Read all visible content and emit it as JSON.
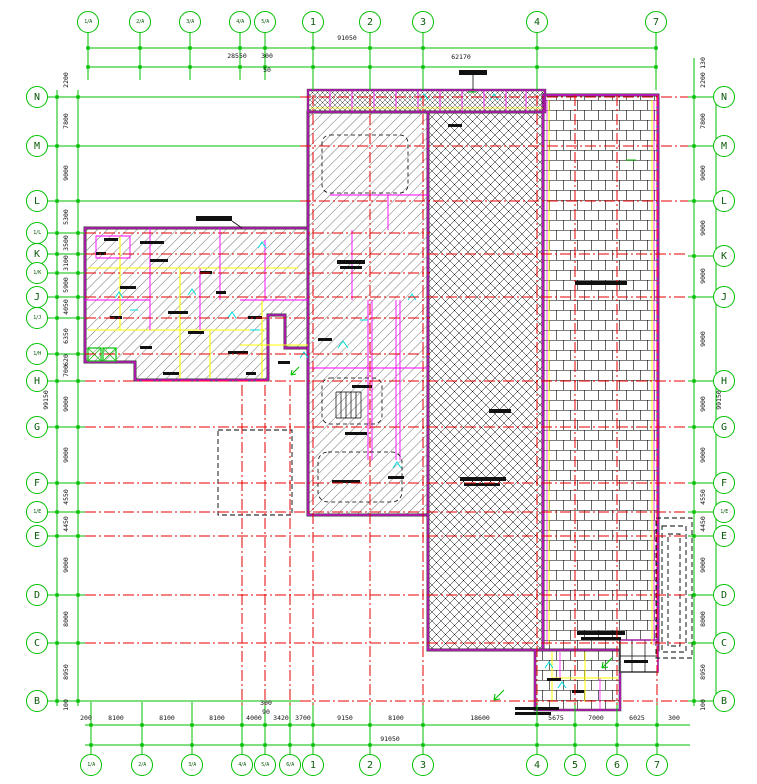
{
  "drawing": {
    "type": "architectural-floor-plan",
    "colors": {
      "grid_green": "#00c000",
      "axis_red": "#e60000",
      "wall_magenta": "#ff00ff",
      "wall_dark": "#3c3c3c",
      "accent_yellow": "#ffff00",
      "accent_cyan": "#00dcdc",
      "hatch_black": "#000000",
      "background": "#ffffff"
    },
    "axes": {
      "top": [
        {
          "label": "1/A",
          "x": 88
        },
        {
          "label": "2/A",
          "x": 140
        },
        {
          "label": "3/A",
          "x": 190
        },
        {
          "label": "4/A",
          "x": 240
        },
        {
          "label": "5/A",
          "x": 265
        },
        {
          "label": "1",
          "x": 313
        },
        {
          "label": "2",
          "x": 370
        },
        {
          "label": "3",
          "x": 423
        },
        {
          "label": "4",
          "x": 537
        },
        {
          "label": "7",
          "x": 656
        }
      ],
      "bottom": [
        {
          "label": "1/A",
          "x": 91
        },
        {
          "label": "2/A",
          "x": 142
        },
        {
          "label": "3/A",
          "x": 192
        },
        {
          "label": "4/A",
          "x": 242
        },
        {
          "label": "5/A",
          "x": 265
        },
        {
          "label": "6/A",
          "x": 290
        },
        {
          "label": "1",
          "x": 313
        },
        {
          "label": "2",
          "x": 370
        },
        {
          "label": "3",
          "x": 423
        },
        {
          "label": "4",
          "x": 537
        },
        {
          "label": "5",
          "x": 575
        },
        {
          "label": "6",
          "x": 617
        },
        {
          "label": "7",
          "x": 657
        }
      ],
      "left": [
        {
          "label": "N",
          "y": 97
        },
        {
          "label": "M",
          "y": 146
        },
        {
          "label": "L",
          "y": 201
        },
        {
          "label": "1/L",
          "y": 233
        },
        {
          "label": "K",
          "y": 254
        },
        {
          "label": "1/K",
          "y": 273
        },
        {
          "label": "J",
          "y": 297
        },
        {
          "label": "1/J",
          "y": 318
        },
        {
          "label": "1/H",
          "y": 354
        },
        {
          "label": "H",
          "y": 381
        },
        {
          "label": "G",
          "y": 427
        },
        {
          "label": "F",
          "y": 483
        },
        {
          "label": "1/E",
          "y": 512
        },
        {
          "label": "E",
          "y": 536
        },
        {
          "label": "D",
          "y": 595
        },
        {
          "label": "C",
          "y": 643
        },
        {
          "label": "B",
          "y": 701
        }
      ],
      "right": [
        {
          "label": "N",
          "y": 97
        },
        {
          "label": "M",
          "y": 146
        },
        {
          "label": "L",
          "y": 201
        },
        {
          "label": "K",
          "y": 256
        },
        {
          "label": "J",
          "y": 297
        },
        {
          "label": "H",
          "y": 381
        },
        {
          "label": "G",
          "y": 427
        },
        {
          "label": "F",
          "y": 483
        },
        {
          "label": "1/E",
          "y": 512
        },
        {
          "label": "E",
          "y": 536
        },
        {
          "label": "D",
          "y": 595
        },
        {
          "label": "C",
          "y": 643
        },
        {
          "label": "B",
          "y": 701
        }
      ]
    },
    "dims": {
      "top": [
        {
          "t": "28550",
          "x": 237,
          "y": 56
        },
        {
          "t": "300",
          "x": 267,
          "y": 56
        },
        {
          "t": "50",
          "x": 267,
          "y": 70
        },
        {
          "t": "91050",
          "x": 347,
          "y": 38
        },
        {
          "t": "62170",
          "x": 461,
          "y": 57
        }
      ],
      "bottom": [
        {
          "t": "200",
          "x": 86,
          "y": 718
        },
        {
          "t": "8100",
          "x": 116,
          "y": 718
        },
        {
          "t": "8100",
          "x": 167,
          "y": 718
        },
        {
          "t": "8100",
          "x": 217,
          "y": 718
        },
        {
          "t": "4000",
          "x": 254,
          "y": 718
        },
        {
          "t": "3420",
          "x": 281,
          "y": 718
        },
        {
          "t": "3700",
          "x": 303,
          "y": 718
        },
        {
          "t": "9150",
          "x": 345,
          "y": 718
        },
        {
          "t": "8100",
          "x": 396,
          "y": 718
        },
        {
          "t": "18600",
          "x": 480,
          "y": 718
        },
        {
          "t": "5675",
          "x": 556,
          "y": 718
        },
        {
          "t": "7000",
          "x": 596,
          "y": 718
        },
        {
          "t": "6025",
          "x": 637,
          "y": 718
        },
        {
          "t": "300",
          "x": 674,
          "y": 718
        },
        {
          "t": "91050",
          "x": 390,
          "y": 739
        },
        {
          "t": "300",
          "x": 266,
          "y": 703
        },
        {
          "t": "90",
          "x": 266,
          "y": 712
        }
      ],
      "left": [
        {
          "t": "2200",
          "x": 66,
          "y": 80,
          "rot": true
        },
        {
          "t": "7800",
          "x": 66,
          "y": 121,
          "rot": true
        },
        {
          "t": "9000",
          "x": 66,
          "y": 173,
          "rot": true
        },
        {
          "t": "5300",
          "x": 66,
          "y": 217,
          "rot": true
        },
        {
          "t": "3500",
          "x": 66,
          "y": 243,
          "rot": true
        },
        {
          "t": "3100",
          "x": 66,
          "y": 263,
          "rot": true
        },
        {
          "t": "5900",
          "x": 66,
          "y": 285,
          "rot": true
        },
        {
          "t": "4050",
          "x": 66,
          "y": 307,
          "rot": true
        },
        {
          "t": "6350",
          "x": 66,
          "y": 336,
          "rot": true
        },
        {
          "t": "620",
          "x": 66,
          "y": 360,
          "rot": true
        },
        {
          "t": "700",
          "x": 66,
          "y": 371,
          "rot": true
        },
        {
          "t": "9000",
          "x": 66,
          "y": 404,
          "rot": true
        },
        {
          "t": "9000",
          "x": 66,
          "y": 455,
          "rot": true
        },
        {
          "t": "4550",
          "x": 66,
          "y": 497,
          "rot": true
        },
        {
          "t": "4450",
          "x": 66,
          "y": 524,
          "rot": true
        },
        {
          "t": "9000",
          "x": 66,
          "y": 565,
          "rot": true
        },
        {
          "t": "8000",
          "x": 66,
          "y": 619,
          "rot": true
        },
        {
          "t": "8950",
          "x": 66,
          "y": 672,
          "rot": true
        },
        {
          "t": "100",
          "x": 66,
          "y": 705,
          "rot": true
        },
        {
          "t": "99150",
          "x": 46,
          "y": 400,
          "rot": true
        }
      ],
      "right": [
        {
          "t": "130",
          "x": 703,
          "y": 63,
          "rot": true
        },
        {
          "t": "2200",
          "x": 703,
          "y": 80,
          "rot": true
        },
        {
          "t": "7800",
          "x": 703,
          "y": 121,
          "rot": true
        },
        {
          "t": "9000",
          "x": 703,
          "y": 173,
          "rot": true
        },
        {
          "t": "9000",
          "x": 703,
          "y": 228,
          "rot": true
        },
        {
          "t": "9000",
          "x": 703,
          "y": 276,
          "rot": true
        },
        {
          "t": "9000",
          "x": 703,
          "y": 339,
          "rot": true
        },
        {
          "t": "9000",
          "x": 703,
          "y": 404,
          "rot": true
        },
        {
          "t": "9000",
          "x": 703,
          "y": 455,
          "rot": true
        },
        {
          "t": "4550",
          "x": 703,
          "y": 497,
          "rot": true
        },
        {
          "t": "4450",
          "x": 703,
          "y": 524,
          "rot": true
        },
        {
          "t": "9000",
          "x": 703,
          "y": 565,
          "rot": true
        },
        {
          "t": "8000",
          "x": 703,
          "y": 619,
          "rot": true
        },
        {
          "t": "8950",
          "x": 703,
          "y": 672,
          "rot": true
        },
        {
          "t": "100",
          "x": 703,
          "y": 705,
          "rot": true
        },
        {
          "t": "99150",
          "x": 719,
          "y": 400,
          "rot": true
        }
      ]
    },
    "layout": {
      "circle_radius": 11,
      "top_circle_y": 22,
      "bottom_circle_y": 765,
      "left_circle_x": 37,
      "right_circle_x": 724,
      "red_vertical_main_span": [
        95,
        705
      ],
      "red_vertical_partial_x": [
        242,
        265,
        290
      ],
      "red_vertical_partial_span": [
        385,
        705
      ],
      "red_horizontal_default_span": [
        85,
        688
      ],
      "red_horizontal_short_rows": [
        "1/L",
        "1/K",
        "1/J",
        "1/H"
      ],
      "red_horizontal_short_span": [
        85,
        430
      ],
      "red_horizontal_right_rows": [
        "N",
        "M",
        "L",
        "B"
      ],
      "red_horizontal_right_span": [
        300,
        688
      ]
    }
  }
}
